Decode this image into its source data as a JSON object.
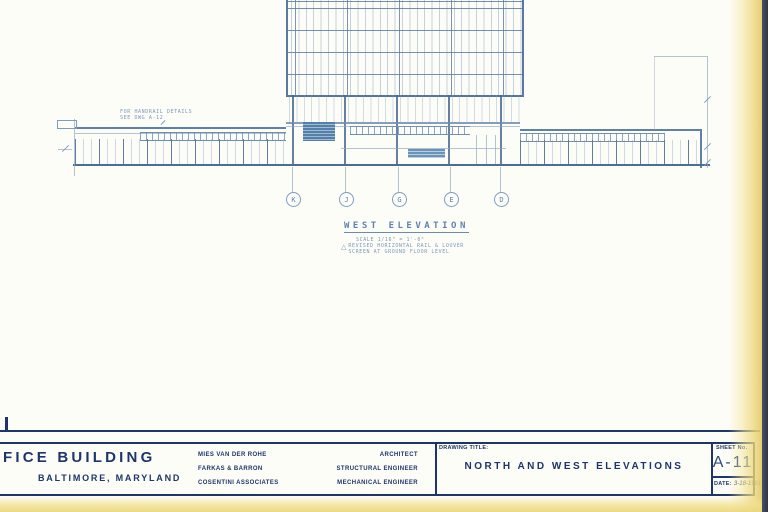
{
  "drawing": {
    "elevation_title": "WEST ELEVATION",
    "scale_note": "SCALE  1/16\" = 1'-0\"",
    "revision_marker": "△",
    "revision_note_line1": "REVISED HORIZONTAL RAIL & LOUVER",
    "revision_note_line2": "SCREEN AT GROUND FLOOR LEVEL",
    "handrail_note_line1": "FOR HANDRAIL DETAILS",
    "handrail_note_line2": "SEE DWG A-12",
    "grid_bubbles": [
      "K",
      "J",
      "G",
      "E",
      "D"
    ]
  },
  "title_block": {
    "project_name": "FICE BUILDING",
    "project_location": "BALTIMORE, MARYLAND",
    "consultants": [
      {
        "name": "MIES VAN DER ROHE",
        "role": "ARCHITECT"
      },
      {
        "name": "FARKAS & BARRON",
        "role": "STRUCTURAL ENGINEER"
      },
      {
        "name": "COSENTINI ASSOCIATES",
        "role": "MECHANICAL ENGINEER"
      }
    ],
    "drawing_title_label": "DRAWING TITLE:",
    "drawing_title": "NORTH AND WEST ELEVATIONS",
    "sheet_label": "SHEET No.",
    "sheet_number": "A-11",
    "date_label": "DATE:",
    "date_value": "3-18-1961"
  },
  "colors": {
    "paper": "#fdfdf8",
    "blueprint_line": "#6d8db4",
    "title_navy": "#1d3569",
    "page_edge_yellow": "#ecd98c"
  }
}
